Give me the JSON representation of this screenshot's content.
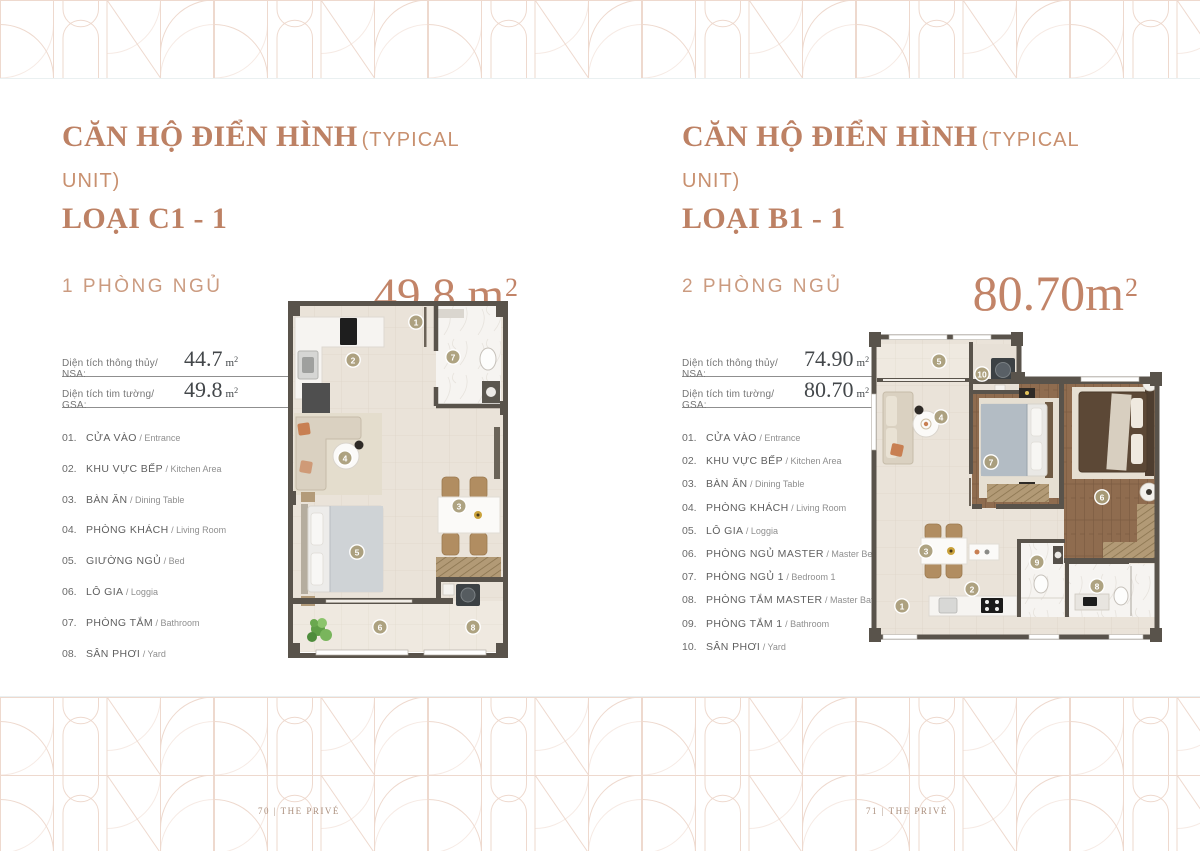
{
  "page": {
    "footer_left": "70 | THE PRIVÉ",
    "footer_right": "71 | THE PRIVÉ"
  },
  "legend_separator": " / ",
  "colors": {
    "accent_terracotta": "#bd8164",
    "accent_number": "#c28468",
    "pattern_line": "#eed9ce",
    "plan_wall": "#59534b",
    "plan_tile": "#eae3d9",
    "plan_wood": "#8f6c4f"
  },
  "units": [
    {
      "title_vi": "CĂN HỘ ĐIỂN HÌNH",
      "title_en": "(TYPICAL UNIT)",
      "type_label": "LOẠI C1 - 1",
      "bedrooms": "1 PHÒNG NGỦ",
      "area_big": {
        "number": "49.8 m",
        "exp": "2"
      },
      "specs": [
        {
          "label": "Diện tích thông thủy/ NSA:",
          "value": "44.7",
          "unit": "m",
          "exp": "2"
        },
        {
          "label": "Diện tích tim tường/ GSA:",
          "value": "49.8",
          "unit": "m",
          "exp": "2"
        }
      ],
      "legend": [
        {
          "num": "01.",
          "vi": "CỬA VÀO",
          "en": "Entrance"
        },
        {
          "num": "02.",
          "vi": "KHU VỰC BẾP",
          "en": "Kitchen Area"
        },
        {
          "num": "03.",
          "vi": "BÀN ĂN",
          "en": "Dining Table"
        },
        {
          "num": "04.",
          "vi": "PHÒNG KHÁCH",
          "en": "Living Room"
        },
        {
          "num": "05.",
          "vi": "GIƯỜNG NGỦ",
          "en": "Bed"
        },
        {
          "num": "06.",
          "vi": "LÔ GIA",
          "en": "Loggia"
        },
        {
          "num": "07.",
          "vi": "PHÒNG TẮM",
          "en": "Bathroom"
        },
        {
          "num": "08.",
          "vi": "SÂN PHƠI",
          "en": "Yard"
        }
      ],
      "plan_markers": [
        {
          "n": "1",
          "x": 128,
          "y": 21
        },
        {
          "n": "2",
          "x": 65,
          "y": 59
        },
        {
          "n": "7",
          "x": 165,
          "y": 56
        },
        {
          "n": "4",
          "x": 57,
          "y": 157
        },
        {
          "n": "3",
          "x": 171,
          "y": 205
        },
        {
          "n": "5",
          "x": 69,
          "y": 251
        },
        {
          "n": "6",
          "x": 92,
          "y": 326
        },
        {
          "n": "8",
          "x": 185,
          "y": 326
        }
      ]
    },
    {
      "title_vi": "CĂN HỘ ĐIỂN HÌNH",
      "title_en": "(TYPICAL UNIT)",
      "type_label": "LOẠI B1 - 1",
      "bedrooms": "2 PHÒNG NGỦ",
      "area_big": {
        "number": "80.70m",
        "exp": "2"
      },
      "specs": [
        {
          "label": "Diện tích thông thủy/ NSA:",
          "value": "74.90",
          "unit": "m",
          "exp": "2"
        },
        {
          "label": "Diện tích tim tường/ GSA:",
          "value": "80.70",
          "unit": "m",
          "exp": "2"
        }
      ],
      "legend": [
        {
          "num": "01.",
          "vi": "CỬA VÀO",
          "en": "Entrance"
        },
        {
          "num": "02.",
          "vi": "KHU VỰC BẾP",
          "en": "Kitchen Area"
        },
        {
          "num": "03.",
          "vi": "BÀN ĂN",
          "en": "Dining Table"
        },
        {
          "num": "04.",
          "vi": "PHÒNG KHÁCH",
          "en": "Living Room"
        },
        {
          "num": "05.",
          "vi": "LÔ GIA",
          "en": "Loggia"
        },
        {
          "num": "06.",
          "vi": "PHÒNG NGỦ MASTER",
          "en": "Master Bedroom"
        },
        {
          "num": "07.",
          "vi": "PHÒNG NGỦ 1",
          "en": "Bedroom 1"
        },
        {
          "num": "08.",
          "vi": "PHÒNG TẮM MASTER",
          "en": "Master Bathroom"
        },
        {
          "num": "09.",
          "vi": "PHÒNG TẮM 1",
          "en": "Bathroom"
        },
        {
          "num": "10.",
          "vi": "SÂN PHƠI",
          "en": "Yard"
        }
      ],
      "plan_markers": [
        {
          "n": "5",
          "x": 70,
          "y": 29
        },
        {
          "n": "10",
          "x": 113,
          "y": 42
        },
        {
          "n": "4",
          "x": 72,
          "y": 85
        },
        {
          "n": "7",
          "x": 122,
          "y": 130
        },
        {
          "n": "6",
          "x": 233,
          "y": 165
        },
        {
          "n": "3",
          "x": 57,
          "y": 219
        },
        {
          "n": "9",
          "x": 168,
          "y": 230
        },
        {
          "n": "2",
          "x": 103,
          "y": 257
        },
        {
          "n": "8",
          "x": 228,
          "y": 254
        },
        {
          "n": "1",
          "x": 33,
          "y": 274
        }
      ]
    }
  ]
}
